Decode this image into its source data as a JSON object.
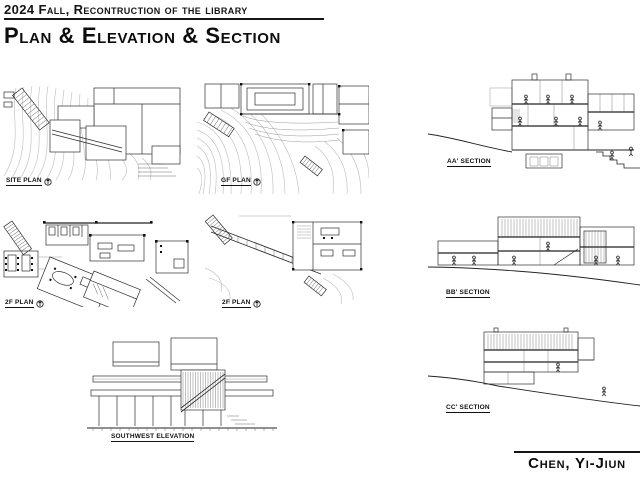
{
  "header": {
    "course_title": "2024 Fall, Recontruction of the library",
    "page_title": "Plan & Elevation & Section"
  },
  "drawings": {
    "site_plan": {
      "label": "SITE PLAN",
      "kind": "plan"
    },
    "gf_plan": {
      "label": "GF PLAN",
      "kind": "plan"
    },
    "floor2_plan_a": {
      "label": "2F PLAN",
      "kind": "plan"
    },
    "floor2_plan_b": {
      "label": "2F PLAN",
      "kind": "plan"
    },
    "southwest_elevation": {
      "label": "SOUTHWEST ELEVATION",
      "kind": "elevation"
    },
    "section_aa": {
      "label": "AA' SECTION",
      "kind": "section"
    },
    "section_bb": {
      "label": "BB' SECTION",
      "kind": "section"
    },
    "section_cc": {
      "label": "CC' SECTION",
      "kind": "section"
    }
  },
  "footer": {
    "author_name": "Chen, Yi-Jiun"
  },
  "colors": {
    "paper": "#ffffff",
    "ink": "#111111",
    "drawing_line": "#2e2e2e",
    "contour_line": "#bcbcbc"
  }
}
